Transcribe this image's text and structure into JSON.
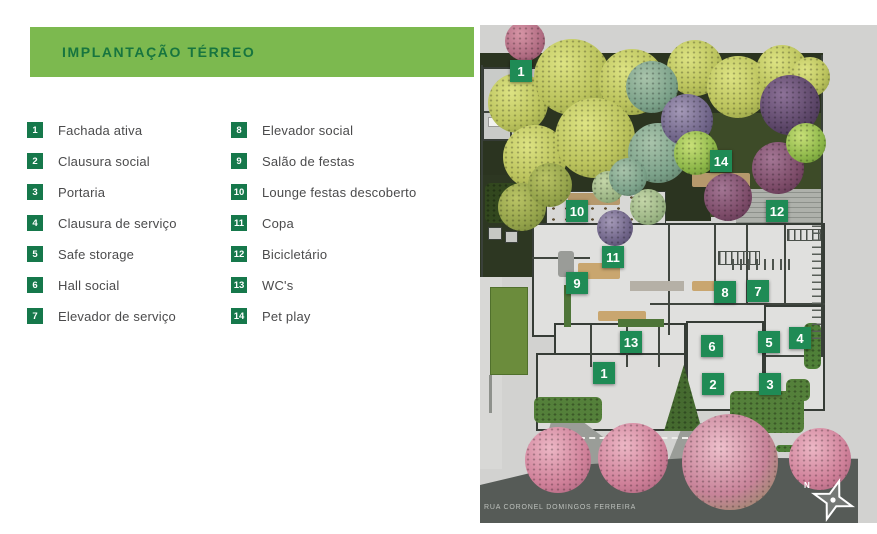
{
  "header": {
    "title": "IMPLANTAÇÃO TÉRREO"
  },
  "legend": {
    "items": [
      {
        "num": "1",
        "label": "Fachada ativa"
      },
      {
        "num": "2",
        "label": "Clausura social"
      },
      {
        "num": "3",
        "label": "Portaria"
      },
      {
        "num": "4",
        "label": "Clausura de serviço"
      },
      {
        "num": "5",
        "label": "Safe storage"
      },
      {
        "num": "6",
        "label": "Hall social"
      },
      {
        "num": "7",
        "label": "Elevador de serviço"
      },
      {
        "num": "8",
        "label": "Elevador social"
      },
      {
        "num": "9",
        "label": "Salão de festas"
      },
      {
        "num": "10",
        "label": "Lounge festas descoberto"
      },
      {
        "num": "11",
        "label": "Copa"
      },
      {
        "num": "12",
        "label": "Bicicletário"
      },
      {
        "num": "13",
        "label": "WC's"
      },
      {
        "num": "14",
        "label": "Pet play"
      }
    ]
  },
  "plan": {
    "street_label": "RUA CORONEL DOMINGOS FERREIRA",
    "compass_label": "N",
    "markers": [
      {
        "num": "1",
        "x": 41,
        "y": 46
      },
      {
        "num": "14",
        "x": 241,
        "y": 136
      },
      {
        "num": "10",
        "x": 97,
        "y": 186
      },
      {
        "num": "12",
        "x": 297,
        "y": 186
      },
      {
        "num": "11",
        "x": 133,
        "y": 232
      },
      {
        "num": "9",
        "x": 97,
        "y": 258
      },
      {
        "num": "8",
        "x": 245,
        "y": 267
      },
      {
        "num": "7",
        "x": 278,
        "y": 266
      },
      {
        "num": "13",
        "x": 151,
        "y": 317
      },
      {
        "num": "6",
        "x": 232,
        "y": 321
      },
      {
        "num": "5",
        "x": 289,
        "y": 317
      },
      {
        "num": "4",
        "x": 320,
        "y": 313
      },
      {
        "num": "1",
        "x": 124,
        "y": 348
      },
      {
        "num": "2",
        "x": 233,
        "y": 359
      },
      {
        "num": "3",
        "x": 290,
        "y": 359
      }
    ]
  },
  "colors": {
    "header_bar": "#7cb94f",
    "header_text": "#17753f",
    "legend_square": "#16784b",
    "marker_square": "#1f8b55",
    "road": "#565b57",
    "garden": "#2b3420",
    "plan_background": "#d2d2d0"
  }
}
